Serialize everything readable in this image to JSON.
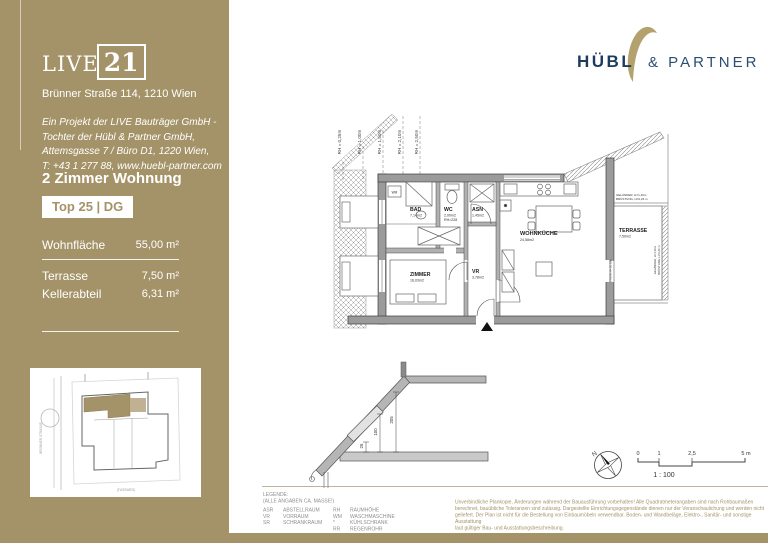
{
  "colors": {
    "gold": "#a49368",
    "navy": "#1f3b5c",
    "navy_light": "#2a4f72",
    "logo_gold": "#b3a26e"
  },
  "sidebar": {
    "logo": {
      "live": "LIVE",
      "num": "21"
    },
    "address": "Brünner Straße 114, 1210 Wien",
    "project_lines": [
      "Ein Projekt der LIVE Bauträger GmbH -",
      "Tochter der Hübl & Partner GmbH,",
      "Attemsgasse 7 / Büro D1, 1220 Wien,",
      "T: +43 1 277 88, www.huebl-partner.com"
    ],
    "unit_type": "2 Zimmer Wohnung",
    "unit_badge": "Top 25 | DG",
    "areas": {
      "wohnflaeche": {
        "label": "Wohnfläche",
        "value": "55,00 m²"
      },
      "terrasse": {
        "label": "Terrasse",
        "value": "7,50 m²"
      },
      "kellerabteil": {
        "label": "Kellerabteil",
        "value": "6,31 m²"
      }
    },
    "siteplan": {
      "street_left": "BRÜNNER STRASSE",
      "street_bottom": "(FUSSWEG)"
    }
  },
  "brand": {
    "name1": "HÜBL",
    "name2": "& PARTNER"
  },
  "plan": {
    "rooms": {
      "bad": {
        "name": "BAD",
        "area": "7,14m2"
      },
      "wc": {
        "name": "WC",
        "area": "2,00m2",
        "rh": "RH=228"
      },
      "asn": {
        "name": "ASN",
        "area": "1,45m2"
      },
      "wohnkueche": {
        "name": "WOHNKÜCHE",
        "area": "24,58m2"
      },
      "zimmer": {
        "name": "ZIMMER",
        "area": "16,03m2"
      },
      "vr": {
        "name": "VR",
        "area": "3,78m2"
      },
      "terrasse": {
        "name": "TERRASSE",
        "area": "7,50m2"
      }
    },
    "rh_labels": [
      "RH = 0,25m",
      "RH = 1,00m",
      "RH = 1,50m",
      "RH = 2,10m",
      "RH = 2,50m"
    ],
    "railing_line1": "GELÄNDER, H=1,10m",
    "railing_line2": "BRÜSTUNG, H=0,26 m",
    "step_label": "STUFE H= 20 CM",
    "wm_label": "WM"
  },
  "section": {
    "dims": [
      "25",
      "100",
      "205"
    ]
  },
  "scalebar": {
    "ticks": [
      "0",
      "1",
      "2,5",
      "5 m"
    ],
    "ratio": "1 : 100",
    "north": "N"
  },
  "legend": {
    "title": "LEGENDE:",
    "subtitle": "(ALLE ANGABEN CA. MASSE!)",
    "col1": [
      {
        "abbr": "ASR",
        "term": "ABSTELLRAUM"
      },
      {
        "abbr": "VR",
        "term": "VORRAUM"
      },
      {
        "abbr": "SR",
        "term": "SCHRANKRAUM"
      }
    ],
    "col2": [
      {
        "abbr": "RH",
        "term": "RAUMHÖHE"
      },
      {
        "abbr": "WM",
        "term": "WASCHMASCHINE"
      },
      {
        "abbr": "*",
        "term": "KÜHLSCHRANK"
      },
      {
        "abbr": "RR",
        "term": "REGENROHR"
      }
    ]
  },
  "disclaimer": {
    "lines": [
      "Unverbindliche Plankopie, Änderungen während der Bauausführung vorbehalten! Alle Quadratmeterangaben sind nach Rohbaumaßen",
      "berechnet, bauübliche Toleranzen sind zulässig. Dargestellte Einrichtungsgegenstände dienen nur der Veranschaulichung und werden nicht",
      "geliefert. Der Plan ist nicht für die Bestellung von Einbaumöbeln verwendbar. Boden- und Wandbeläge, Elektro-, Sanitär- und sonstige Ausstattung",
      "laut gültiger Bau- und Ausstattungsbeschreibung."
    ]
  }
}
